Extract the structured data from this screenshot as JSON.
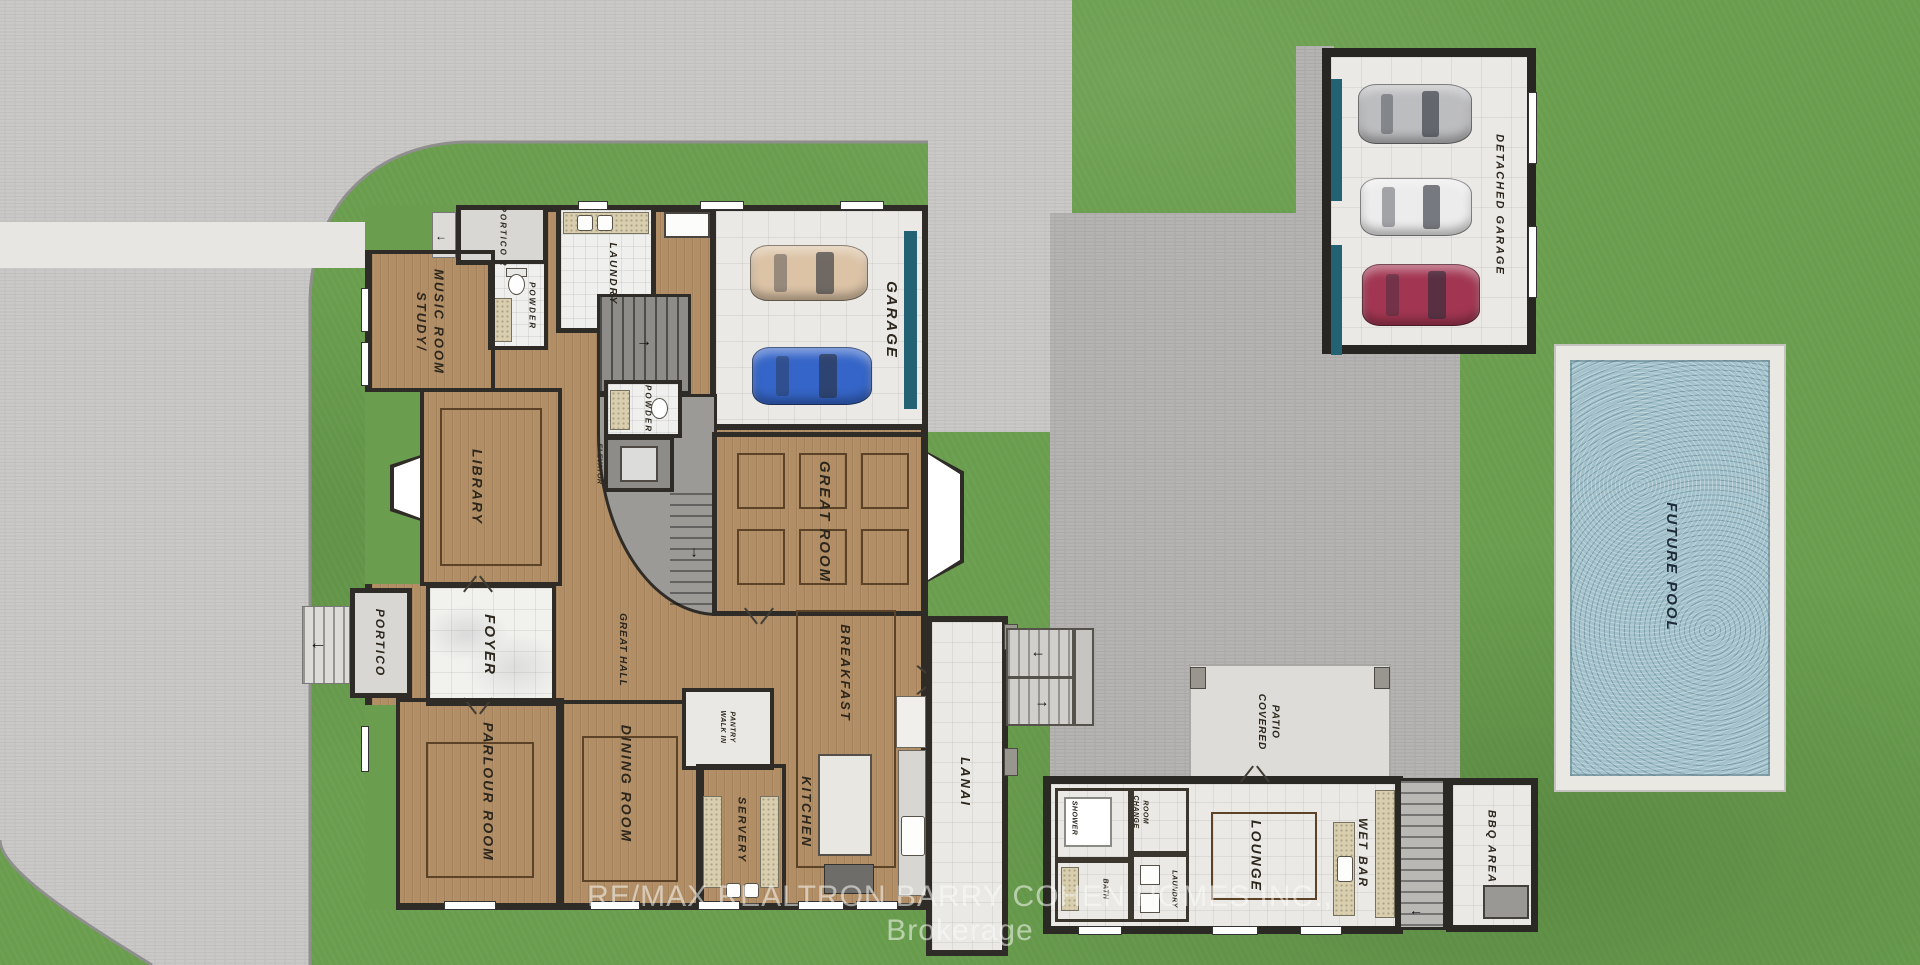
{
  "watermark": "RE/MAX REALTRON BARRY COHEN HOMES INC.,  Brokerage",
  "labels": {
    "portico2": "PORTICO 2",
    "powder_main": "POWDER",
    "laundry_main": "LAUNDRY",
    "study": "STUDY/\nMUSIC ROOM",
    "library": "LIBRARY",
    "portico": "PORTICO",
    "foyer": "FOYER",
    "great_hall": "GREAT HALL",
    "elevator": "ELEVATOR",
    "powder_hall": "POWDER",
    "garage": "GARAGE",
    "great_room": "GREAT ROOM",
    "parlour": "PARLOUR ROOM",
    "dining": "DINING ROOM",
    "walk_in_pantry": "WALK IN\nPANTRY",
    "servery": "SERVERY",
    "kitchen": "KITCHEN",
    "breakfast": "BREAKFAST",
    "lanai": "LANAI",
    "shower": "SHOWER",
    "change_room": "CHANGE\nROOM",
    "bath": "BATH",
    "laundry_pool": "LAUNDRY",
    "lounge": "LOUNGE",
    "wet_bar": "WET BAR",
    "covered_patio": "COVERED\nPATIO",
    "bbq_area": "BBQ AREA",
    "detached_garage": "DETACHED GARAGE",
    "future_pool": "FUTURE POOL"
  },
  "icons": {
    "arrow_left": "←",
    "arrow_right": "→",
    "arrow_down": "↓"
  },
  "colors": {
    "grass": "#6a9e4e",
    "street_pavement": "#cac9c7",
    "courtyard_pavement": "#b5b4b2",
    "walkway": "#e7e6e2",
    "wood_floor": "#b18e66",
    "wall": "#2f2c27",
    "tile_floor": "#ebe9e6",
    "marble_floor": "#f1f1ee",
    "patio_concrete": "#dddcd8",
    "pool_water": "#a3c2cc",
    "pool_deck": "#e9e8e3",
    "garage_door_teal": "#226273",
    "counter_speckle": "#d9cfae",
    "watermark_color": "rgba(250,252,248,0.55)"
  },
  "cars": {
    "attached_garage": [
      "#dcc3a6",
      "#3565c8"
    ],
    "detached_garage": [
      "#bcbdbf",
      "#ececec",
      "#a23652"
    ]
  }
}
